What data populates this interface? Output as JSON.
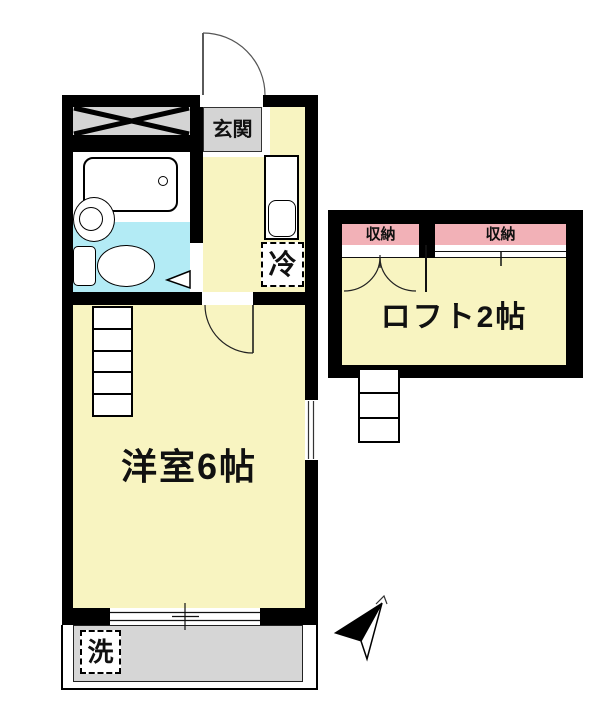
{
  "labels": {
    "entrance": "玄関",
    "storage_left": "収納",
    "storage_right": "収納",
    "loft": "ロフト2帖",
    "main_room": "洋室6帖",
    "refrigerator": "冷",
    "washer": "洗"
  },
  "colors": {
    "floor_yellow": "#F8F4C1",
    "storage_pink": "#F2B1B7",
    "bath_cyan": "#B3EBF5",
    "gray_area": "#D4D4D4",
    "deck_gray": "#D6D6D6",
    "wall": "#000000"
  }
}
